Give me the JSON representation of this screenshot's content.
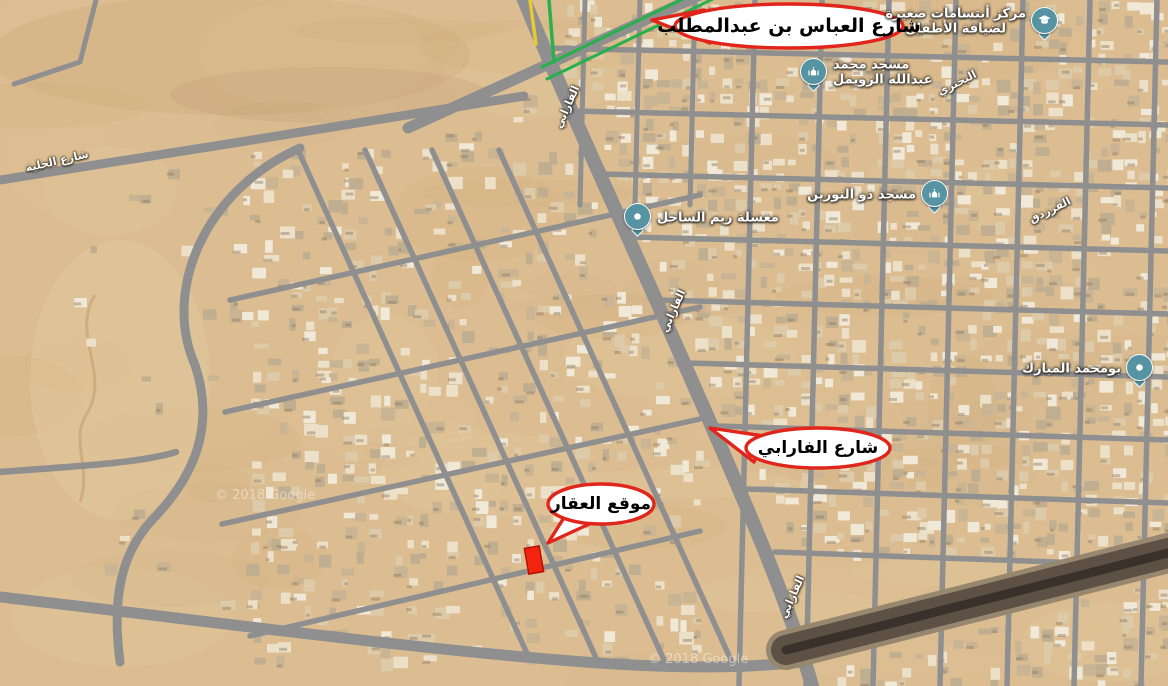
{
  "map": {
    "attribution_left": "© 2018 Google",
    "attribution_bottom": "© 2018 Google",
    "colors": {
      "sand": "#dcbd92",
      "road": "#8f8f8f",
      "road_dark": "#5d5044",
      "highlight_green": "#27b04b",
      "highlight_yellow": "#e8c931",
      "callout_red": "#e1251b",
      "marker_red": "#f3240f",
      "pin_teal": "#5693a3",
      "label_white": "#ffffff"
    }
  },
  "callouts": [
    {
      "id": "abbas-street",
      "text": "شارع العباس بن عبدالمطلب"
    },
    {
      "id": "farabi-street",
      "text": "شارع الفارابي"
    },
    {
      "id": "property-location",
      "text": "موقع العقار"
    }
  ],
  "pois": [
    {
      "id": "children-center",
      "line1": "مركز أبتسامات صغيرة",
      "line2": "لضيافة الأطفال",
      "icon": "graduation-cap-icon"
    },
    {
      "id": "mosque-zuwaimel",
      "line1": "مسجد محمد",
      "line2": "عبدالله الزويمل",
      "icon": "mosque-icon"
    },
    {
      "id": "laundry-reem",
      "line1": "مغسلة ريم الساحل",
      "line2": "",
      "icon": "place-dot-icon"
    },
    {
      "id": "mosque-nurayn",
      "line1": "مسجد ذو النورين",
      "line2": "",
      "icon": "mosque-icon"
    },
    {
      "id": "abu-mohammed-mubarak",
      "line1": "بومحمد المبارك",
      "line2": "",
      "icon": "place-dot-icon"
    }
  ],
  "street_labels": [
    {
      "text": "شارع الحلية"
    },
    {
      "text": "الفارابي"
    },
    {
      "text": "الفارابي"
    },
    {
      "text": "الفارابي"
    },
    {
      "text": "البحتري"
    },
    {
      "text": "الفرزدق"
    }
  ]
}
